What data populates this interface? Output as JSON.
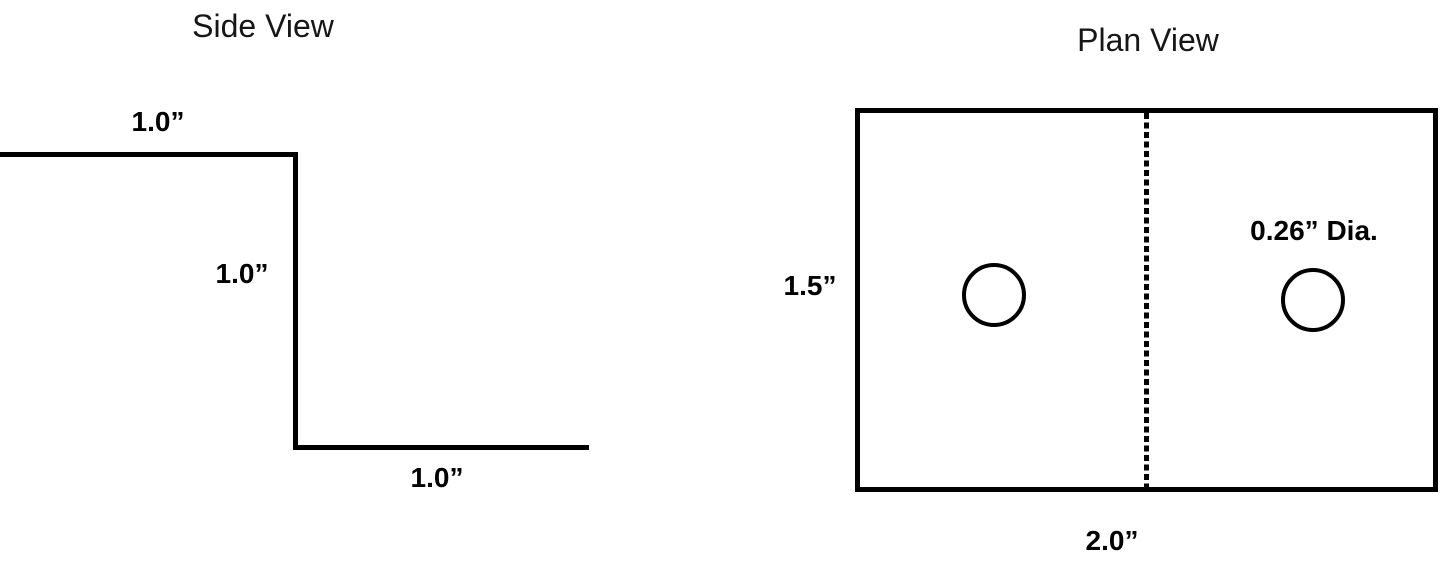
{
  "colors": {
    "background": "#ffffff",
    "line": "#000000"
  },
  "side_view": {
    "title": "Side View",
    "dimensions": {
      "top_width": "1.0”",
      "step_height": "1.0”",
      "bottom_width": "1.0”"
    }
  },
  "plan_view": {
    "title": "Plan View",
    "height": "1.5”",
    "width": "2.0”",
    "hole_diameter": "0.26” Dia."
  }
}
